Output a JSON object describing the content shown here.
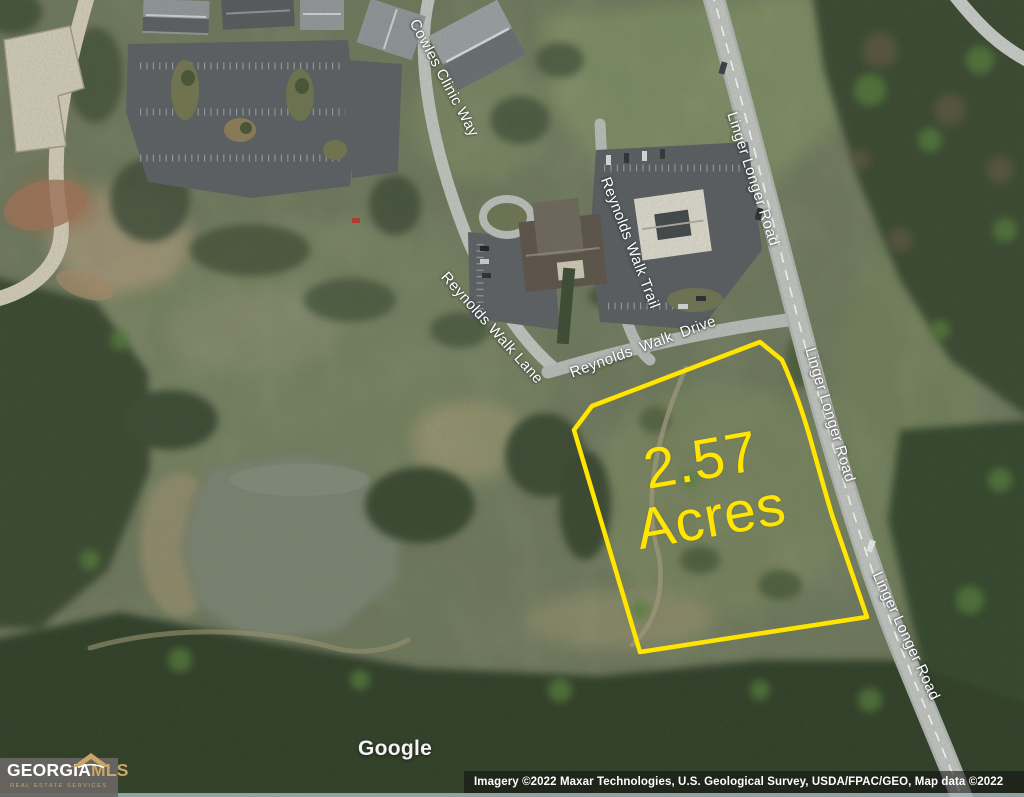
{
  "map": {
    "labels": {
      "cowles": "Cowles Clinic Way",
      "trail": "Reynolds Walk Trail",
      "lane": "Reynolds Walk Lane",
      "drive": "Reynolds Walk Drive",
      "linger1": "Linger Longer Road",
      "linger2": "Linger Longer Road",
      "linger3": "Linger Longer Road"
    },
    "parcel": {
      "area_line1": "2.57",
      "area_line2": "Acres"
    }
  },
  "watermark": {
    "google": "Google"
  },
  "attribution": {
    "text": "Imagery ©2022 Maxar Technologies, U.S. Geological Survey, USDA/FPAC/GEO, Map data ©2022"
  },
  "logo": {
    "brand_primary": "GEORGIA",
    "brand_secondary": "MLS",
    "tagline": "REAL ESTATE SERVICES"
  },
  "colors": {
    "parcel_outline": "#FFE500",
    "area_text": "#FFE500",
    "road_label_text": "#FFFFFF",
    "logo_gold": "#C9A567"
  }
}
